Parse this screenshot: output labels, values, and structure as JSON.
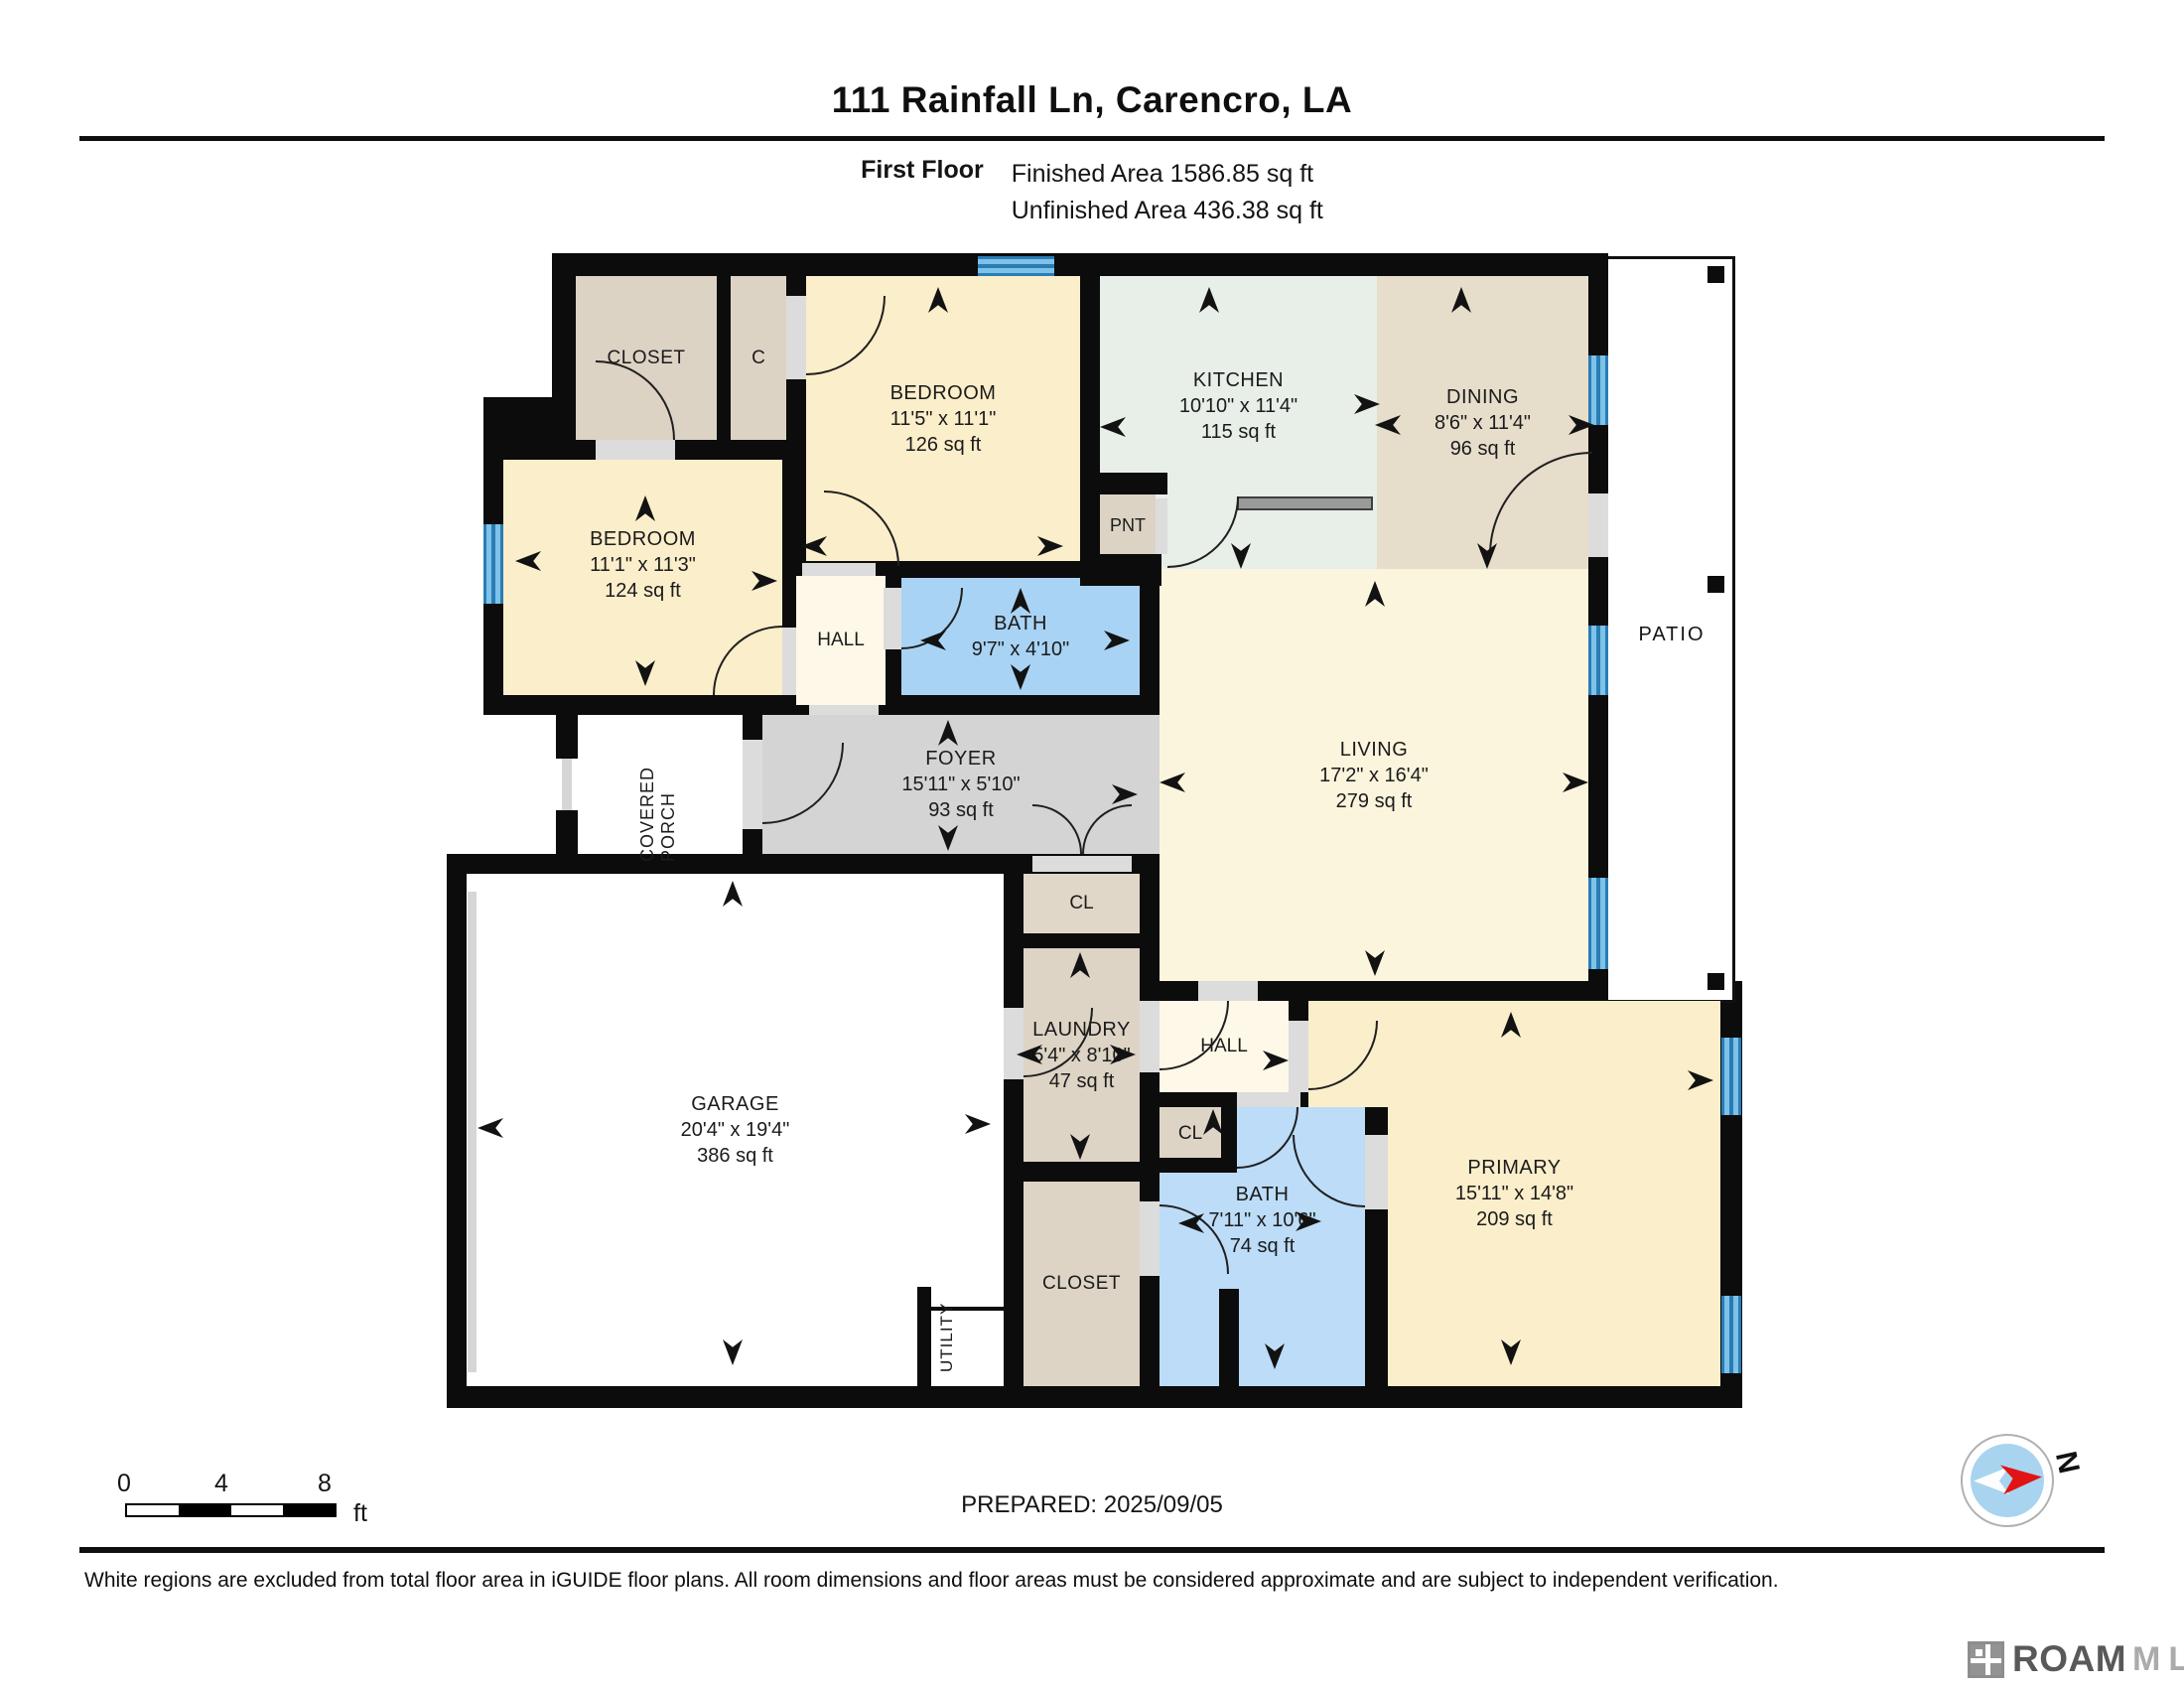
{
  "header": {
    "title": "111 Rainfall Ln, Carencro, LA",
    "floor_label": "First Floor",
    "finished_area": "Finished Area 1586.85 sq ft",
    "unfinished_area": "Unfinished Area 436.38 sq ft"
  },
  "rooms": {
    "closet_top": {
      "name": "CLOSET"
    },
    "closet_c": {
      "name": "C"
    },
    "bedroom_a": {
      "name": "BEDROOM",
      "dims": "11'5\" x 11'1\"",
      "area": "126 sq ft"
    },
    "kitchen": {
      "name": "KITCHEN",
      "dims": "10'10\" x 11'4\"",
      "area": "115 sq ft"
    },
    "dining": {
      "name": "DINING",
      "dims": "8'6\" x 11'4\"",
      "area": "96 sq ft"
    },
    "bedroom_b": {
      "name": "BEDROOM",
      "dims": "11'1\" x 11'3\"",
      "area": "124 sq ft"
    },
    "pnt": {
      "name": "PNT"
    },
    "hall_upper": {
      "name": "HALL"
    },
    "bath_upper": {
      "name": "BATH",
      "dims": "9'7\" x 4'10\""
    },
    "foyer": {
      "name": "FOYER",
      "dims": "15'11\" x 5'10\"",
      "area": "93 sq ft"
    },
    "living": {
      "name": "LIVING",
      "dims": "17'2\" x 16'4\"",
      "area": "279 sq ft"
    },
    "covered_porch": {
      "name": "COVERED PORCH"
    },
    "patio": {
      "name": "PATIO"
    },
    "closet_foyer": {
      "name": "CL"
    },
    "laundry": {
      "name": "LAUNDRY",
      "dims": "5'4\" x 8'10\"",
      "area": "47 sq ft"
    },
    "hall_lower": {
      "name": "HALL"
    },
    "garage": {
      "name": "GARAGE",
      "dims": "20'4\" x 19'4\"",
      "area": "386 sq ft"
    },
    "closet_hall": {
      "name": "CL"
    },
    "bath_primary": {
      "name": "BATH",
      "dims": "7'11\" x 10'6\"",
      "area": "74 sq ft"
    },
    "closet_primary": {
      "name": "CLOSET"
    },
    "utility": {
      "name": "UTILITY"
    },
    "primary": {
      "name": "PRIMARY",
      "dims": "15'11\" x 14'8\"",
      "area": "209 sq ft"
    }
  },
  "footer": {
    "prepared": "PREPARED: 2025/09/05",
    "disclaimer": "White regions are excluded from total floor area in iGUIDE floor plans. All room dimensions and floor areas must be considered approximate and are subject to independent verification.",
    "compass_label": "N",
    "scale": {
      "labels": [
        "0",
        "4",
        "8"
      ],
      "unit": "ft"
    },
    "brand": {
      "primary": "ROAM",
      "secondary": "MLS"
    }
  },
  "colors": {
    "wall": "#0c0c0c",
    "bedroom_fill": "#fbeeca",
    "living_fill": "#fcf5dd",
    "hall_fill": "#fdf8e8",
    "closet_fill": "#dcd3c4",
    "dining_fill": "#e6ddcb",
    "kitchen_fill": "#e7efe8",
    "bath_fill": "#a9d3f4",
    "bath_primary_fill": "#bcdcf7",
    "foyer_fill": "#d4d4d4",
    "window_blue": "#5fb0dc",
    "door_gap": "#dcdcdc"
  }
}
